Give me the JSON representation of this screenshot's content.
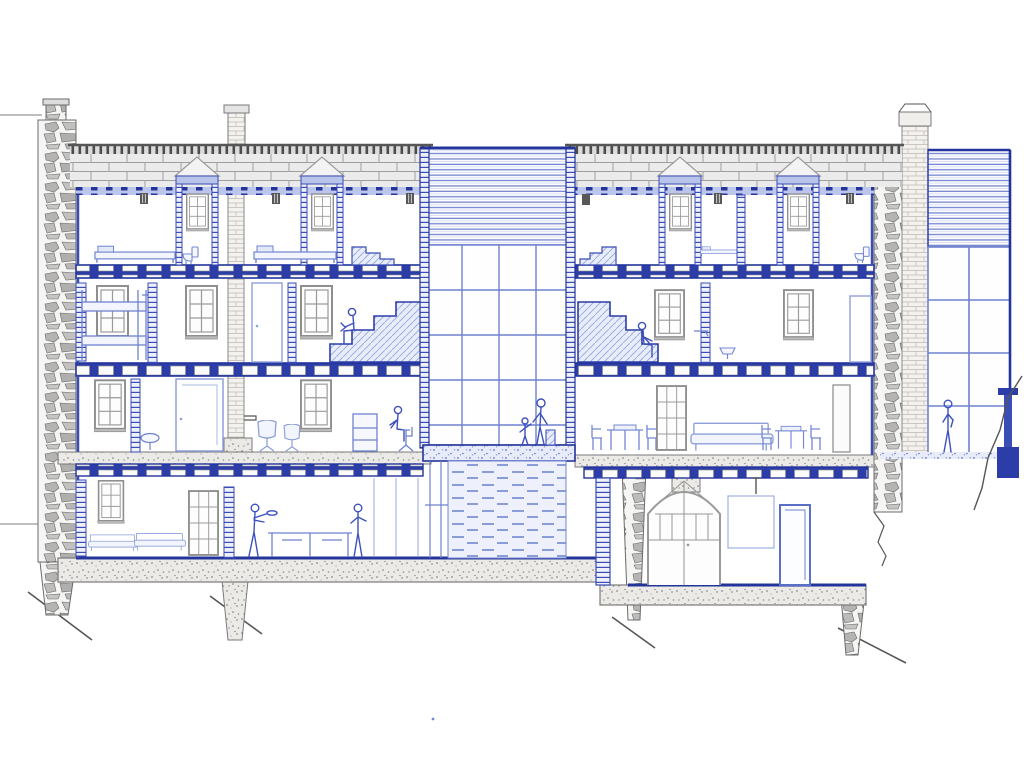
{
  "document": {
    "type": "architectural-section-drawing",
    "title": "Hand-drawn longitudinal building section",
    "medium": "blue ink with grey pencil on white paper",
    "description": "Cross-section through a four-level terraced building: attic with dormers, two main floors, basement; a full-height glazed atrium with louvred top at centre; rubble-stone party walls; brick chimneys; a glazed conservatory annexe on the right standing on sloping rocky ground."
  },
  "palette": {
    "paper": "#ffffff",
    "ink_dark": "#23349b",
    "ink": "#3a4cb5",
    "ink_mid": "#6f82cf",
    "ink_light": "#aab8e2",
    "ink_wash": "#dce3f6",
    "pencil_dark": "#565656",
    "pencil": "#979797",
    "pencil_light": "#c9c9c9",
    "stone_fill": "#b5b4b2",
    "concrete_fill": "#eceae7"
  },
  "scene": {
    "levels": [
      "attic",
      "second-floor",
      "ground-floor",
      "basement"
    ],
    "left_block_rooms": [
      "attic bedroom with bed and WC dormer",
      "attic bedroom with bed and dormer",
      "attic stair landing",
      "bunk-bed room",
      "bedroom with door",
      "stair room with seated figure",
      "living room with armchairs, sink, desk and office chair",
      "basement lounge-kitchen with sofas, cook and counter"
    ],
    "right_block_rooms": [
      "attic room with stair landing and bed",
      "attic room with dormers and WC",
      "stair room with seated figure",
      "bathroom with basin",
      "dining room with tables, chairs and sofa",
      "basement store with arched door and blue door"
    ],
    "atrium": [
      "louvred clerestory screen",
      "glazed curtain wall",
      "mid-level landing slab",
      "dashed masonry core below landing",
      "access ladder"
    ],
    "conservatory": [
      "louvred roof screen",
      "large glazing grid",
      "standing visitor",
      "blue column",
      "rock cliff line"
    ],
    "figures": [
      {
        "label": "person seated on left stair"
      },
      {
        "label": "person seated on right stair"
      },
      {
        "label": "person on office chair"
      },
      {
        "label": "adult with child and suitcase on atrium landing"
      },
      {
        "label": "cook flipping a pan at basement counter"
      },
      {
        "label": "person standing at basement glazing"
      },
      {
        "label": "person standing in conservatory"
      }
    ]
  }
}
